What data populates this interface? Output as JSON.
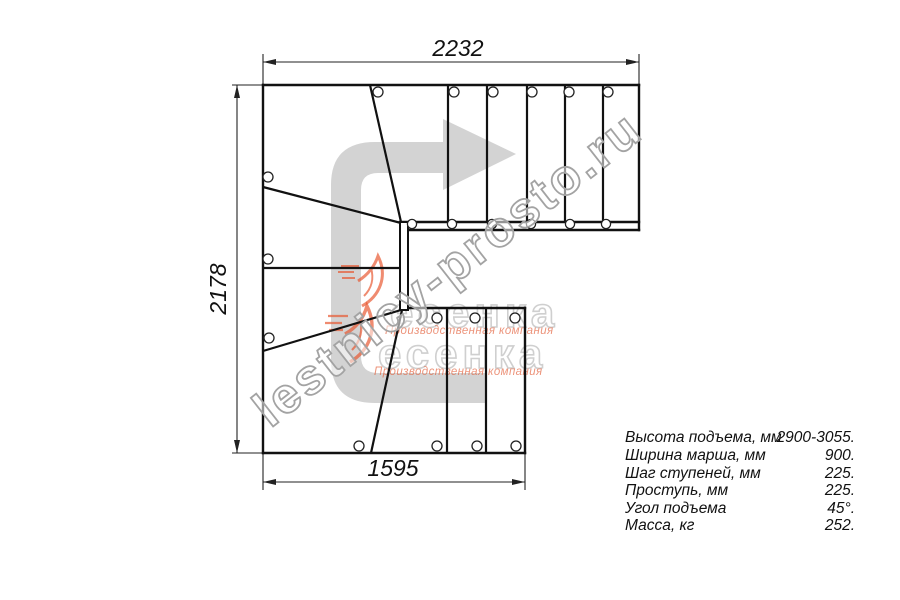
{
  "drawing": {
    "dim_top": "2232",
    "dim_left": "2178",
    "dim_bottom": "1595"
  },
  "specs": [
    {
      "label": "Высота подъема, мм",
      "value": "2900-3055."
    },
    {
      "label": "Ширина марша, мм",
      "value": "900."
    },
    {
      "label": "Шаг ступеней, мм",
      "value": "225."
    },
    {
      "label": "Проступь, мм",
      "value": "225."
    },
    {
      "label": "Угол подъема",
      "value": "45°."
    },
    {
      "label": "Масса, кг",
      "value": "252."
    }
  ],
  "logo": {
    "brand": "есенка",
    "caption": "Производственная компания"
  },
  "watermark": "lestnicy-prosto.ru",
  "colors": {
    "line": "#111111",
    "dimension": "#222222",
    "arrow_fill": "#d3d3d3",
    "logo_orange": "#e2552f",
    "logo_gray": "#c7c7c7",
    "watermark_stroke": "#a3a3a3"
  }
}
